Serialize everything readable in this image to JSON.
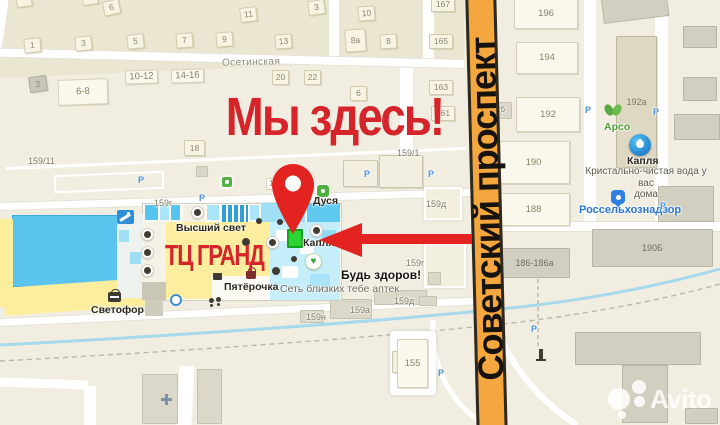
{
  "annotations": {
    "headline": "Мы здесь!",
    "mall_label": "ТЦ ГРАНД",
    "main_street": "Советский проспект"
  },
  "watermark": {
    "brand": "Avito"
  },
  "colors": {
    "accent_red": "#d6242b",
    "pin_red": "#e2231f",
    "road_orange": "#f4a73f",
    "highlight_green": "#2bd333",
    "mall_yellow": "#fcee9d",
    "mall_blue": "#5ac4ee"
  },
  "map": {
    "buildings": [
      {
        "x": 16,
        "y": -6,
        "w": 16,
        "h": 13,
        "rot": -8
      },
      {
        "x": 82,
        "y": -8,
        "w": 16,
        "h": 13,
        "rot": -8
      },
      {
        "x": 24,
        "y": 38,
        "w": 17,
        "h": 15,
        "rot": -6,
        "label": "1"
      },
      {
        "x": 75,
        "y": 36,
        "w": 17,
        "h": 15,
        "rot": -6,
        "label": "3"
      },
      {
        "x": 127,
        "y": 34,
        "w": 17,
        "h": 15,
        "rot": -6,
        "label": "5"
      },
      {
        "x": 176,
        "y": 33,
        "w": 17,
        "h": 15,
        "rot": -5,
        "label": "7"
      },
      {
        "x": 216,
        "y": 32,
        "w": 17,
        "h": 15,
        "rot": -5,
        "label": "9"
      },
      {
        "x": 103,
        "y": 0,
        "w": 17,
        "h": 15,
        "rot": -12,
        "label": "6"
      },
      {
        "x": 240,
        "y": 7,
        "w": 17,
        "h": 15,
        "rot": -7,
        "label": "11"
      },
      {
        "x": 275,
        "y": 34,
        "w": 17,
        "h": 15,
        "rot": -5,
        "label": "13"
      },
      {
        "x": 308,
        "y": 0,
        "w": 17,
        "h": 15,
        "rot": -8,
        "label": "3"
      },
      {
        "x": 358,
        "y": 6,
        "w": 17,
        "h": 15,
        "rot": -5,
        "label": "10"
      },
      {
        "x": 345,
        "y": 29,
        "w": 21,
        "h": 23,
        "rot": -4,
        "label": "8а"
      },
      {
        "x": 380,
        "y": 34,
        "w": 17,
        "h": 15,
        "rot": -4,
        "label": "8"
      },
      {
        "x": 431,
        "y": -3,
        "w": 24,
        "h": 15,
        "label": "167"
      },
      {
        "x": 429,
        "y": 34,
        "w": 24,
        "h": 15,
        "label": "165"
      },
      {
        "x": 29,
        "y": 76,
        "w": 18,
        "h": 16,
        "rot": -8,
        "cls": "gray",
        "label": "2"
      },
      {
        "x": 272,
        "y": 70,
        "w": 17,
        "h": 15,
        "label": "20"
      },
      {
        "x": 304,
        "y": 70,
        "w": 17,
        "h": 15,
        "label": "22"
      },
      {
        "x": 350,
        "y": 86,
        "w": 17,
        "h": 15,
        "label": "6"
      },
      {
        "x": 429,
        "y": 80,
        "w": 24,
        "h": 15,
        "label": "163"
      },
      {
        "x": 431,
        "y": 106,
        "w": 24,
        "h": 15,
        "label": "161"
      },
      {
        "x": 184,
        "y": 140,
        "w": 21,
        "h": 16,
        "label": "18"
      },
      {
        "x": 58,
        "y": 79,
        "w": 50,
        "h": 26,
        "rot": -2,
        "cls": "plain",
        "label": "6-8"
      },
      {
        "x": 125,
        "y": 70,
        "w": 33,
        "h": 14,
        "rot": -2,
        "cls": "plain",
        "label": "10-12"
      },
      {
        "x": 171,
        "y": 69,
        "w": 33,
        "h": 14,
        "rot": -2,
        "cls": "plain",
        "label": "14-16"
      },
      {
        "x": 514,
        "y": -2,
        "w": 64,
        "h": 31,
        "cls": "plain",
        "label": "196"
      },
      {
        "x": 516,
        "y": 42,
        "w": 62,
        "h": 32,
        "cls": "plain",
        "label": "194"
      },
      {
        "x": 516,
        "y": 97,
        "w": 64,
        "h": 35,
        "cls": "plain",
        "label": "192"
      },
      {
        "x": 488,
        "y": 102,
        "w": 24,
        "h": 17,
        "cls": "grayb2"
      },
      {
        "x": 616,
        "y": 36,
        "w": 41,
        "h": 132,
        "cls": "tall",
        "label": "192а"
      },
      {
        "x": 497,
        "y": 141,
        "w": 73,
        "h": 43,
        "cls": "plain",
        "label": "190"
      },
      {
        "x": 497,
        "y": 193,
        "w": 73,
        "h": 33,
        "cls": "plain",
        "label": "188"
      },
      {
        "x": 499,
        "y": 248,
        "w": 71,
        "h": 30,
        "cls": "grayb",
        "label": "186-186а"
      },
      {
        "x": 592,
        "y": 229,
        "w": 121,
        "h": 38,
        "cls": "grayb",
        "label": "190Б"
      },
      {
        "x": 602,
        "y": -8,
        "w": 66,
        "h": 28,
        "rot": -7,
        "cls": "grayb"
      },
      {
        "x": 683,
        "y": 26,
        "w": 34,
        "h": 22,
        "cls": "grayb"
      },
      {
        "x": 683,
        "y": 77,
        "w": 34,
        "h": 24,
        "cls": "grayb"
      },
      {
        "x": 674,
        "y": 114,
        "w": 46,
        "h": 26,
        "cls": "grayb"
      },
      {
        "x": 658,
        "y": 186,
        "w": 56,
        "h": 36,
        "cls": "grayb"
      },
      {
        "x": 575,
        "y": 332,
        "w": 126,
        "h": 33,
        "cls": "grayb"
      },
      {
        "x": 622,
        "y": 365,
        "w": 46,
        "h": 58,
        "cls": "grayb"
      },
      {
        "x": 685,
        "y": 408,
        "w": 33,
        "h": 16,
        "cls": "grayb"
      },
      {
        "x": 142,
        "y": 374,
        "w": 36,
        "h": 50,
        "cls": "grayb2"
      },
      {
        "x": 197,
        "y": 369,
        "w": 25,
        "h": 55,
        "cls": "grayb2"
      },
      {
        "x": 343,
        "y": 160,
        "w": 35,
        "h": 27,
        "cls": "plain2"
      },
      {
        "x": 379,
        "y": 155,
        "w": 44,
        "h": 33,
        "cls": "plain2"
      },
      {
        "x": 424,
        "y": 187,
        "w": 38,
        "h": 33,
        "cls": "outlined"
      },
      {
        "x": 424,
        "y": 243,
        "w": 42,
        "h": 45,
        "cls": "outlined"
      },
      {
        "x": 428,
        "y": 272,
        "w": 13,
        "h": 13,
        "cls": "grayb2"
      },
      {
        "x": 196,
        "y": 166,
        "w": 12,
        "h": 11,
        "rot": -2,
        "cls": "grayb2"
      },
      {
        "x": 300,
        "y": 310,
        "w": 24,
        "h": 13,
        "cls": "grayb2"
      },
      {
        "x": 330,
        "y": 299,
        "w": 42,
        "h": 20,
        "cls": "grayb2"
      },
      {
        "x": 374,
        "y": 292,
        "w": 23,
        "h": 13,
        "cls": "grayb2"
      },
      {
        "x": 396,
        "y": 290,
        "w": 31,
        "h": 15,
        "cls": "grayb2"
      },
      {
        "x": 419,
        "y": 296,
        "w": 18,
        "h": 10,
        "cls": "grayb2"
      },
      {
        "x": 390,
        "y": 331,
        "w": 46,
        "h": 64,
        "cls": "hlout"
      },
      {
        "x": 392,
        "y": 351,
        "w": 12,
        "h": 22,
        "cls": "plain2"
      },
      {
        "x": 397,
        "y": 339,
        "w": 31,
        "h": 49,
        "cls": "plain",
        "label": "155"
      }
    ],
    "labels": [
      {
        "x": 222,
        "y": 57,
        "cls": "street",
        "rot": -1.4,
        "text": "Осетинская",
        "name": "street-label-osetinskaya"
      },
      {
        "x": 28,
        "y": 156,
        "cls": "bare",
        "text": "159/11"
      },
      {
        "x": 397,
        "y": 148,
        "cls": "bare",
        "text": "159/1"
      },
      {
        "x": 154,
        "y": 198,
        "cls": "bare",
        "text": "159г"
      },
      {
        "x": 426,
        "y": 199,
        "cls": "bare",
        "text": "159д"
      },
      {
        "x": 406,
        "y": 258,
        "cls": "bare",
        "text": "159г"
      },
      {
        "x": 306,
        "y": 312,
        "cls": "bare",
        "text": "159н"
      },
      {
        "x": 350,
        "y": 305,
        "cls": "bare",
        "text": "159а"
      },
      {
        "x": 394,
        "y": 296,
        "cls": "bare",
        "text": "159д"
      },
      {
        "x": 488,
        "y": 333,
        "cls": "bare",
        "text": "184"
      },
      {
        "x": 487,
        "y": 105,
        "cls": "bare8",
        "text": "192б"
      },
      {
        "x": 266,
        "y": 178,
        "cls": "plaque",
        "text": "159/3"
      },
      {
        "x": 176,
        "y": 222,
        "cls": "poi",
        "text": "Высший свет",
        "name": "poi-label-vysshiy-svet"
      },
      {
        "x": 313,
        "y": 195,
        "cls": "poi",
        "text": "Дуся",
        "name": "poi-label-dusya"
      },
      {
        "x": 303,
        "y": 237,
        "cls": "poi",
        "text": "Капля",
        "name": "poi-label-kaplya-mall"
      },
      {
        "x": 224,
        "y": 281,
        "cls": "poi",
        "text": "Пятёрочка",
        "name": "poi-label-pyaterochka"
      },
      {
        "x": 341,
        "y": 269,
        "cls": "poi12",
        "text": "Будь здоров!",
        "name": "poi-label-bud-zdorov"
      },
      {
        "x": 280,
        "y": 283,
        "cls": "sub",
        "text": "Сеть близких тебе аптек"
      },
      {
        "x": 91,
        "y": 304,
        "cls": "poi",
        "text": "Светофор",
        "name": "poi-label-svetofor"
      },
      {
        "x": 604,
        "y": 121,
        "cls": "poi-green",
        "text": "Арсо",
        "name": "poi-label-arso"
      },
      {
        "x": 627,
        "y": 155,
        "cls": "poi",
        "text": "Капля",
        "name": "poi-label-kaplya-water"
      },
      {
        "x": 581,
        "y": 166,
        "w": 130,
        "cls": "sub-c",
        "text": "Кристально-чистая вода у вас\nдома"
      },
      {
        "x": 579,
        "y": 204,
        "cls": "poi-blue",
        "text": "Россельхознадзор",
        "name": "poi-label-rosselkhoznadzor"
      },
      {
        "x": 138,
        "y": 175,
        "cls": "pmark",
        "text": "Р"
      },
      {
        "x": 199,
        "y": 193,
        "cls": "pmark",
        "text": "Р"
      },
      {
        "x": 364,
        "y": 169,
        "cls": "pmark",
        "text": "Р"
      },
      {
        "x": 428,
        "y": 169,
        "cls": "pmark",
        "text": "Р"
      },
      {
        "x": 585,
        "y": 105,
        "cls": "pmark",
        "text": "Р"
      },
      {
        "x": 653,
        "y": 107,
        "cls": "pmark",
        "text": "Р"
      },
      {
        "x": 660,
        "y": 201,
        "cls": "pmark",
        "text": "Р"
      },
      {
        "x": 531,
        "y": 324,
        "cls": "pmark",
        "text": "Р"
      },
      {
        "x": 438,
        "y": 368,
        "cls": "pmark",
        "text": "Р"
      }
    ]
  }
}
